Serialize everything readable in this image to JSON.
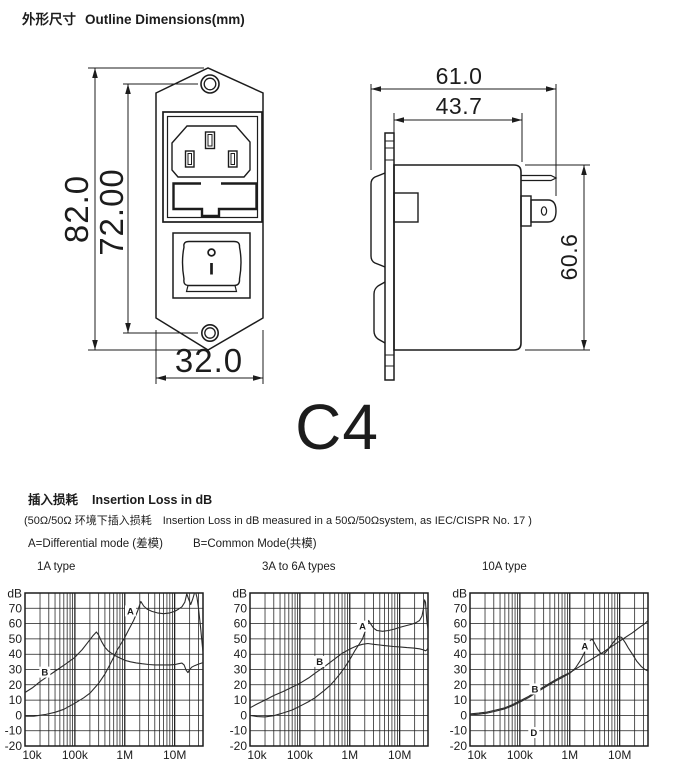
{
  "page": {
    "background": "#ffffff",
    "ink": "#1c1c1c"
  },
  "outline_section": {
    "title_zh": "外形尺寸",
    "title_en": "Outline Dimensions(mm)",
    "model_label": "C4",
    "front_view": {
      "overall_height_mm": "82.0",
      "mounting_hole_spacing_mm": "72.00",
      "width_mm": "32.0"
    },
    "side_view": {
      "overall_depth_mm": "61.0",
      "body_depth_mm": "43.7",
      "body_height_mm": "60.6"
    }
  },
  "insertion_section": {
    "title_zh": "插入损耗",
    "title_en": "Insertion Loss in dB",
    "condition_line": "(50Ω/50Ω 环境下插入损耗　Insertion Loss in dB measured in a 50Ω/50Ωsystem, as IEC/CISPR No. 17 )",
    "mode_a": "A=Differential mode (差模)",
    "mode_b": "B=Common Mode(共模)"
  },
  "chart_data": [
    {
      "type": "line",
      "title": "1A type",
      "unit_label": "dB",
      "grid": "log-x",
      "xlim": [
        10000,
        37000000
      ],
      "ylim": [
        -20,
        80
      ],
      "x_ticks": [
        [
          10000,
          "10k"
        ],
        [
          100000,
          "100k"
        ],
        [
          1000000,
          "1M"
        ],
        [
          10000000,
          "10M"
        ]
      ],
      "y_ticks": [
        [
          70,
          "70"
        ],
        [
          60,
          "60"
        ],
        [
          50,
          "50"
        ],
        [
          40,
          "40"
        ],
        [
          30,
          "30"
        ],
        [
          20,
          "20"
        ],
        [
          10,
          "10"
        ],
        [
          0,
          "0"
        ],
        [
          -10,
          "-10"
        ],
        [
          -20,
          "-20"
        ]
      ],
      "series": [
        {
          "name": "A",
          "label_at": [
            1300000,
            66
          ],
          "points": [
            [
              10000,
              -0.5
            ],
            [
              15000,
              -0.5
            ],
            [
              25000,
              0.5
            ],
            [
              40000,
              2
            ],
            [
              60000,
              4
            ],
            [
              100000,
              8
            ],
            [
              150000,
              11.5
            ],
            [
              200000,
              14.5
            ],
            [
              300000,
              21
            ],
            [
              400000,
              27
            ],
            [
              500000,
              33
            ],
            [
              600000,
              38
            ],
            [
              700000,
              42.5
            ],
            [
              850000,
              47
            ],
            [
              1000000,
              51
            ],
            [
              1200000,
              56
            ],
            [
              1500000,
              62
            ],
            [
              1800000,
              68
            ],
            [
              2100000,
              74.5
            ],
            [
              2400000,
              71.5
            ],
            [
              2800000,
              69.5
            ],
            [
              3500000,
              68
            ],
            [
              4500000,
              67
            ],
            [
              6000000,
              66.5
            ],
            [
              8000000,
              67
            ],
            [
              10000000,
              68
            ],
            [
              12000000,
              69.5
            ],
            [
              14000000,
              71
            ],
            [
              16000000,
              74
            ],
            [
              17500000,
              79.5
            ],
            [
              19000000,
              76
            ],
            [
              21000000,
              72.5
            ],
            [
              23000000,
              76
            ],
            [
              25000000,
              80
            ],
            [
              26500000,
              80
            ],
            [
              28000000,
              77
            ],
            [
              30000000,
              70
            ],
            [
              33000000,
              58
            ],
            [
              36000000,
              45
            ],
            [
              37000000,
              41
            ]
          ]
        },
        {
          "name": "B",
          "label_at": [
            25000,
            26
          ],
          "points": [
            [
              10000,
              15
            ],
            [
              14000,
              18
            ],
            [
              20000,
              22
            ],
            [
              30000,
              26
            ],
            [
              45000,
              30
            ],
            [
              65000,
              33.5
            ],
            [
              100000,
              38
            ],
            [
              140000,
              43
            ],
            [
              180000,
              47.5
            ],
            [
              230000,
              52
            ],
            [
              270000,
              54.5
            ],
            [
              300000,
              52.5
            ],
            [
              340000,
              48.5
            ],
            [
              400000,
              44.5
            ],
            [
              470000,
              42
            ],
            [
              550000,
              40.5
            ],
            [
              650000,
              39
            ],
            [
              800000,
              37.5
            ],
            [
              1000000,
              36
            ],
            [
              1300000,
              35
            ],
            [
              1700000,
              34.3
            ],
            [
              2200000,
              33.8
            ],
            [
              3000000,
              33.3
            ],
            [
              4000000,
              33
            ],
            [
              6000000,
              33
            ],
            [
              8000000,
              33
            ],
            [
              10000000,
              33.2
            ],
            [
              12000000,
              33.8
            ],
            [
              14000000,
              34.2
            ],
            [
              15500000,
              33
            ],
            [
              17000000,
              29.5
            ],
            [
              18500000,
              28
            ],
            [
              20000000,
              30
            ],
            [
              22000000,
              31.5
            ],
            [
              25000000,
              32.5
            ],
            [
              30000000,
              33.5
            ],
            [
              37000000,
              34.5
            ]
          ]
        }
      ],
      "annotations": []
    },
    {
      "type": "line",
      "title": "3A to 6A types",
      "unit_label": "dB",
      "grid": "log-x",
      "xlim": [
        10000,
        37000000
      ],
      "ylim": [
        -20,
        80
      ],
      "x_ticks": [
        [
          10000,
          "10k"
        ],
        [
          100000,
          "100k"
        ],
        [
          1000000,
          "1M"
        ],
        [
          10000000,
          "10M"
        ]
      ],
      "y_ticks": [
        [
          70,
          "70"
        ],
        [
          60,
          "60"
        ],
        [
          50,
          "50"
        ],
        [
          40,
          "40"
        ],
        [
          30,
          "30"
        ],
        [
          20,
          "20"
        ],
        [
          10,
          "10"
        ],
        [
          0,
          "0"
        ],
        [
          -10,
          "-10"
        ],
        [
          -20,
          "-20"
        ]
      ],
      "series": [
        {
          "name": "A",
          "label_at": [
            1800000,
            56
          ],
          "points": [
            [
              10000,
              0
            ],
            [
              14000,
              -0.8
            ],
            [
              20000,
              -1
            ],
            [
              30000,
              -0.2
            ],
            [
              45000,
              1.5
            ],
            [
              70000,
              3.5
            ],
            [
              100000,
              6
            ],
            [
              150000,
              9
            ],
            [
              200000,
              11.5
            ],
            [
              300000,
              16
            ],
            [
              400000,
              19.5
            ],
            [
              500000,
              23
            ],
            [
              650000,
              27.5
            ],
            [
              800000,
              31.5
            ],
            [
              1000000,
              36.5
            ],
            [
              1250000,
              42
            ],
            [
              1500000,
              46
            ],
            [
              1800000,
              50
            ],
            [
              2100000,
              56
            ],
            [
              2400000,
              62
            ],
            [
              2600000,
              60
            ],
            [
              3000000,
              57
            ],
            [
              3500000,
              55.5
            ],
            [
              4500000,
              55
            ],
            [
              6000000,
              55.5
            ],
            [
              8000000,
              56.5
            ],
            [
              10000000,
              57.5
            ],
            [
              13000000,
              58.5
            ],
            [
              17000000,
              59.5
            ],
            [
              21000000,
              60.5
            ],
            [
              25000000,
              62
            ],
            [
              28000000,
              65
            ],
            [
              30000000,
              70
            ],
            [
              31500000,
              75.5
            ],
            [
              33000000,
              74
            ],
            [
              35000000,
              62
            ],
            [
              37000000,
              56
            ]
          ]
        },
        {
          "name": "B",
          "label_at": [
            250000,
            33
          ],
          "points": [
            [
              10000,
              5
            ],
            [
              14000,
              7.5
            ],
            [
              20000,
              10
            ],
            [
              30000,
              13
            ],
            [
              45000,
              15.5
            ],
            [
              70000,
              18.5
            ],
            [
              100000,
              21
            ],
            [
              150000,
              24.5
            ],
            [
              200000,
              27.5
            ],
            [
              300000,
              31.5
            ],
            [
              400000,
              34.5
            ],
            [
              550000,
              38
            ],
            [
              700000,
              40.5
            ],
            [
              900000,
              42.5
            ],
            [
              1100000,
              44
            ],
            [
              1400000,
              45.5
            ],
            [
              1800000,
              46.5
            ],
            [
              2300000,
              47
            ],
            [
              3000000,
              46.5
            ],
            [
              4000000,
              46
            ],
            [
              5500000,
              45.5
            ],
            [
              7500000,
              45
            ],
            [
              10000000,
              44.8
            ],
            [
              14000000,
              44.3
            ],
            [
              19000000,
              44
            ],
            [
              25000000,
              43.5
            ],
            [
              30000000,
              42.8
            ],
            [
              33000000,
              42.2
            ],
            [
              35000000,
              42.8
            ],
            [
              37000000,
              44
            ]
          ]
        }
      ],
      "annotations": []
    },
    {
      "type": "line",
      "title": "10A type",
      "unit_label": "dB",
      "grid": "log-x",
      "xlim": [
        10000,
        37000000
      ],
      "ylim": [
        -20,
        80
      ],
      "x_ticks": [
        [
          10000,
          "10k"
        ],
        [
          100000,
          "100k"
        ],
        [
          1000000,
          "1M"
        ],
        [
          10000000,
          "10M"
        ]
      ],
      "y_ticks": [
        [
          70,
          "70"
        ],
        [
          60,
          "60"
        ],
        [
          50,
          "50"
        ],
        [
          40,
          "40"
        ],
        [
          30,
          "30"
        ],
        [
          20,
          "20"
        ],
        [
          10,
          "10"
        ],
        [
          0,
          "0"
        ],
        [
          -10,
          "-10"
        ],
        [
          -20,
          "-20"
        ]
      ],
      "series": [
        {
          "name": "A",
          "label_at": [
            2000000,
            43
          ],
          "points": [
            [
              10000,
              0.3
            ],
            [
              15000,
              0.8
            ],
            [
              22000,
              1.5
            ],
            [
              33000,
              2.8
            ],
            [
              50000,
              4.3
            ],
            [
              70000,
              6.2
            ],
            [
              100000,
              8.7
            ],
            [
              150000,
              11.7
            ],
            [
              220000,
              15.2
            ],
            [
              330000,
              18.7
            ],
            [
              500000,
              22.2
            ],
            [
              700000,
              24.7
            ],
            [
              1000000,
              27.5
            ],
            [
              1300000,
              31
            ],
            [
              1600000,
              35.5
            ],
            [
              1900000,
              40
            ],
            [
              2200000,
              45
            ],
            [
              2500000,
              48.5
            ],
            [
              2800000,
              50
            ],
            [
              3100000,
              47.5
            ],
            [
              3600000,
              43.5
            ],
            [
              4200000,
              40.5
            ],
            [
              4800000,
              40
            ],
            [
              5500000,
              42
            ],
            [
              6500000,
              45
            ],
            [
              8000000,
              49
            ],
            [
              9500000,
              51.5
            ],
            [
              11000000,
              51
            ],
            [
              13000000,
              47.5
            ],
            [
              15000000,
              44
            ],
            [
              18000000,
              40
            ],
            [
              22000000,
              35.5
            ],
            [
              27000000,
              32
            ],
            [
              32000000,
              30
            ],
            [
              37000000,
              29
            ]
          ]
        },
        {
          "name": "B",
          "label_at": [
            200000,
            15
          ],
          "points": [
            [
              10000,
              1
            ],
            [
              15000,
              1.5
            ],
            [
              22000,
              2.2
            ],
            [
              33000,
              3.5
            ],
            [
              50000,
              5
            ],
            [
              70000,
              7
            ],
            [
              100000,
              9.5
            ],
            [
              150000,
              12.5
            ],
            [
              220000,
              16
            ],
            [
              330000,
              19.5
            ],
            [
              500000,
              23
            ],
            [
              700000,
              25.5
            ],
            [
              1000000,
              28
            ],
            [
              1500000,
              31.5
            ],
            [
              2000000,
              34
            ],
            [
              3000000,
              37.5
            ],
            [
              4500000,
              41
            ],
            [
              6500000,
              44.5
            ],
            [
              9000000,
              47.5
            ],
            [
              13000000,
              51
            ],
            [
              18000000,
              54
            ],
            [
              25000000,
              57.5
            ],
            [
              32000000,
              60
            ],
            [
              37000000,
              62
            ]
          ]
        }
      ],
      "annotations": [
        {
          "text": "D",
          "at": [
            190000,
            -13.5
          ]
        }
      ]
    }
  ]
}
